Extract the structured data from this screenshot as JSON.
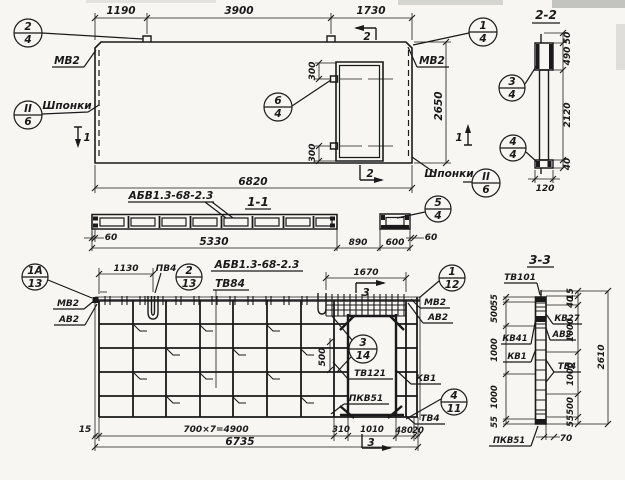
{
  "plan": {
    "dim_1190": "1190",
    "dim_3900": "3900",
    "dim_1730": "1730",
    "dim_6820": "6820",
    "dim_2650": "2650",
    "dim_300_top": "300",
    "dim_300_bot": "300",
    "mv2_left": "МВ2",
    "mv2_right": "МВ2",
    "keys_left": "Шпонки",
    "keys_right": "Шпонки",
    "sec1_left": "1",
    "sec1_right": "1",
    "sec2_top": "2",
    "sec2_bot": "2",
    "c24": {
      "n": "2",
      "s": "4"
    },
    "c14": {
      "n": "1",
      "s": "4"
    },
    "c64": {
      "n": "6",
      "s": "4"
    },
    "cII6L": {
      "n": "II",
      "s": "6"
    },
    "cII6R": {
      "n": "II",
      "s": "6"
    }
  },
  "sec22": {
    "title": "2-2",
    "d50": "50",
    "d490": "490",
    "d2120": "2120",
    "d40": "40",
    "d120": "120",
    "c34": {
      "n": "3",
      "s": "4"
    },
    "c44": {
      "n": "4",
      "s": "4"
    }
  },
  "sec11": {
    "title": "1-1",
    "mark": "АБВ1.3-68-2.3",
    "d60l": "60",
    "d5330": "5330",
    "d890": "890",
    "d600": "600",
    "d60r": "60",
    "c54": {
      "n": "5",
      "s": "4"
    }
  },
  "rebar": {
    "title": "АБВ1.3-68-2.3",
    "tv84": "ТВ84",
    "pv4": "ПВ4",
    "mv2_left": "МВ2",
    "av2_left": "АВ2",
    "mv2_right": "МВ2",
    "av2_right": "АВ2",
    "tv121": "ТВ121",
    "kv1": "КВ1",
    "pkv51": "ПКВ51",
    "tv4": "ТВ4",
    "d1130": "1130",
    "d1670": "1670",
    "d500": "500",
    "d15": "15",
    "d4900": "700×7=4900",
    "d310": "310",
    "d1010": "1010",
    "d480": "480",
    "d20": "20",
    "d6735": "6735",
    "sec3_top": "3",
    "sec3_bot": "3",
    "c1a13": {
      "n": "1А",
      "s": "13"
    },
    "c213": {
      "n": "2",
      "s": "13"
    },
    "c112": {
      "n": "1",
      "s": "12"
    },
    "c314": {
      "n": "3",
      "s": "14"
    },
    "c411": {
      "n": "4",
      "s": "11"
    }
  },
  "sec33": {
    "title": "3-3",
    "tv101": "ТВ101",
    "kv27": "КВ27",
    "av2": "АВ2",
    "tv4": "ТВ4",
    "kv41": "КВ41",
    "kv1": "КВ1",
    "pkv51": "ПКВ51",
    "left": [
      "55",
      "500",
      "1000",
      "1000",
      "55"
    ],
    "right": [
      "15",
      "40",
      "1000",
      "1000",
      "500",
      "55"
    ],
    "d2610": "2610",
    "d70": "70"
  }
}
